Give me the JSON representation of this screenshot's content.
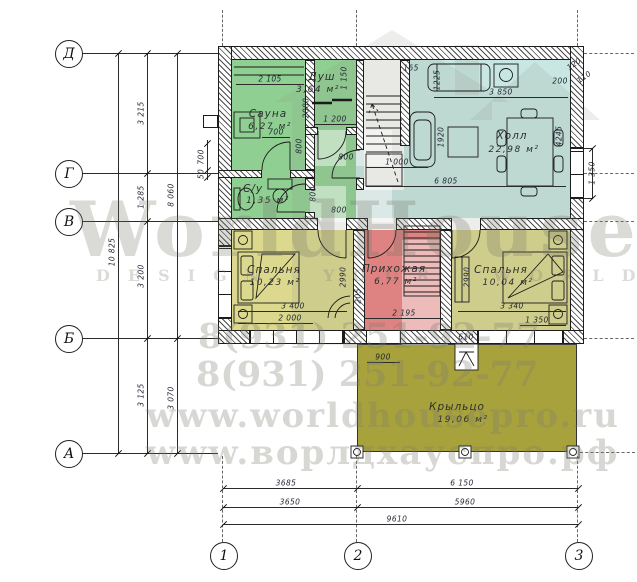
{
  "watermark": {
    "brand": "WorldHouse",
    "tagline": "DESIGN YOUR WORLD",
    "phone": "8(931) 251-92-77",
    "site_en": "www.worldhousepro.ru",
    "site_ru": "www.ворлдхауспро.рф"
  },
  "axes": {
    "rows": [
      "Д",
      "Г",
      "В",
      "Б",
      "А"
    ],
    "cols": [
      "1",
      "2",
      "3"
    ]
  },
  "rooms": {
    "sauna": {
      "name": "Сауна",
      "area": "6,27 м²"
    },
    "shower": {
      "name": "Душ",
      "area": "3,64 м²"
    },
    "wc": {
      "name": "С/у",
      "area": "1,35 м²"
    },
    "hall": {
      "name": "Холл",
      "area": "22,98 м²"
    },
    "bedroom_left": {
      "name": "Спальня",
      "area": "10,23 м²"
    },
    "hallway": {
      "name": "Прихожая",
      "area": "6,77 м²"
    },
    "bedroom_right": {
      "name": "Спальня",
      "area": "10,04 м²"
    },
    "porch": {
      "name": "Крыльцо",
      "area": "19,06 м²"
    }
  },
  "dims": {
    "left": {
      "dg": "3 215",
      "gv": "1 285",
      "vb": "3 200",
      "ba": "3 125",
      "total": "10 825",
      "upper": "8 060",
      "lower": "3 070",
      "vent": "700",
      "vent2": "50"
    },
    "bottom": {
      "r1a": "3685",
      "r1b": "6 150",
      "r2a": "3650",
      "r2b": "5960",
      "total": "9610"
    },
    "right": {
      "a": "200",
      "b": "120",
      "c": "110",
      "hall": "4245",
      "window": "1 350"
    },
    "in": {
      "sauna_w": "2 105",
      "sauna_h": "2080",
      "shower_h": "1 150",
      "shower_w": "1 200",
      "sauna_door": "700",
      "hall_door": "800",
      "shower_door": "800",
      "wc_door": "800",
      "wc_door2": "800",
      "stairs": "1 000",
      "top_a": "165",
      "top_b": "1225",
      "hall_top": "3 850",
      "hall_d": "1920",
      "hall_w": "6 805",
      "bed1_d": "2990",
      "bed1_w": "3 400",
      "bed1_win": "2 000",
      "off": "205",
      "hallway_w": "2 195",
      "bed2_d": "2990",
      "bed2_w": "3 340",
      "bed2_win": "1 350",
      "entry": "610",
      "step": "900"
    }
  },
  "colors": {
    "sauna": "#8fd092",
    "hall": "#c8e6e2",
    "bedroom": "#dcd98e",
    "hallway": "#ee8181",
    "porch": "#a8a23c"
  }
}
